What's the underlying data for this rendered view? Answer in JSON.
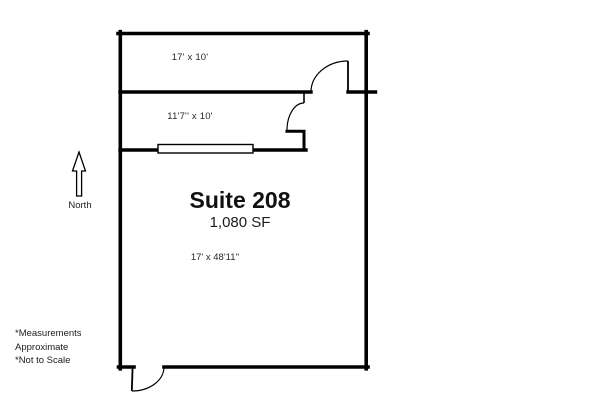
{
  "floorplan": {
    "title": "Suite 208",
    "area": "1,080 SF",
    "main_dimensions": "17' x 48'11''",
    "rooms": [
      {
        "name": "top-room",
        "label": "17' x 10'"
      },
      {
        "name": "middle-room",
        "label": "11'7'' x 10'"
      }
    ],
    "compass": {
      "icon": "north-arrow-icon",
      "label": "North"
    },
    "footnotes": [
      "*Measurements",
      "Approximate",
      "*Not to Scale"
    ],
    "colors": {
      "wall": "#000000",
      "background": "#ffffff",
      "text": "#1f1f1f"
    }
  }
}
